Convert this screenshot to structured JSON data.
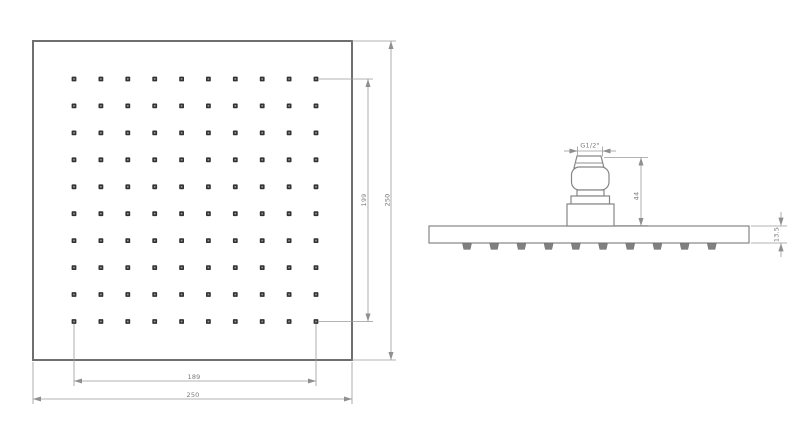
{
  "drawing": {
    "plan_view": {
      "grid": {
        "rows": 10,
        "cols": 10
      },
      "labels": {
        "holes_span_bottom": "189",
        "overall_bottom": "250",
        "holes_span_right": "199",
        "overall_right": "250"
      }
    },
    "side_view": {
      "nozzle_count": 10,
      "labels": {
        "thread": "G1/2\"",
        "connector_height": "44",
        "plate_thickness": "13.5"
      }
    },
    "colors": {
      "outline": "#6f6f6f",
      "detail_line": "#868686",
      "dimension_line": "#9a9a9a",
      "text": "#7a7a7a",
      "hole_fill": "#333333",
      "background": "#ffffff"
    }
  }
}
